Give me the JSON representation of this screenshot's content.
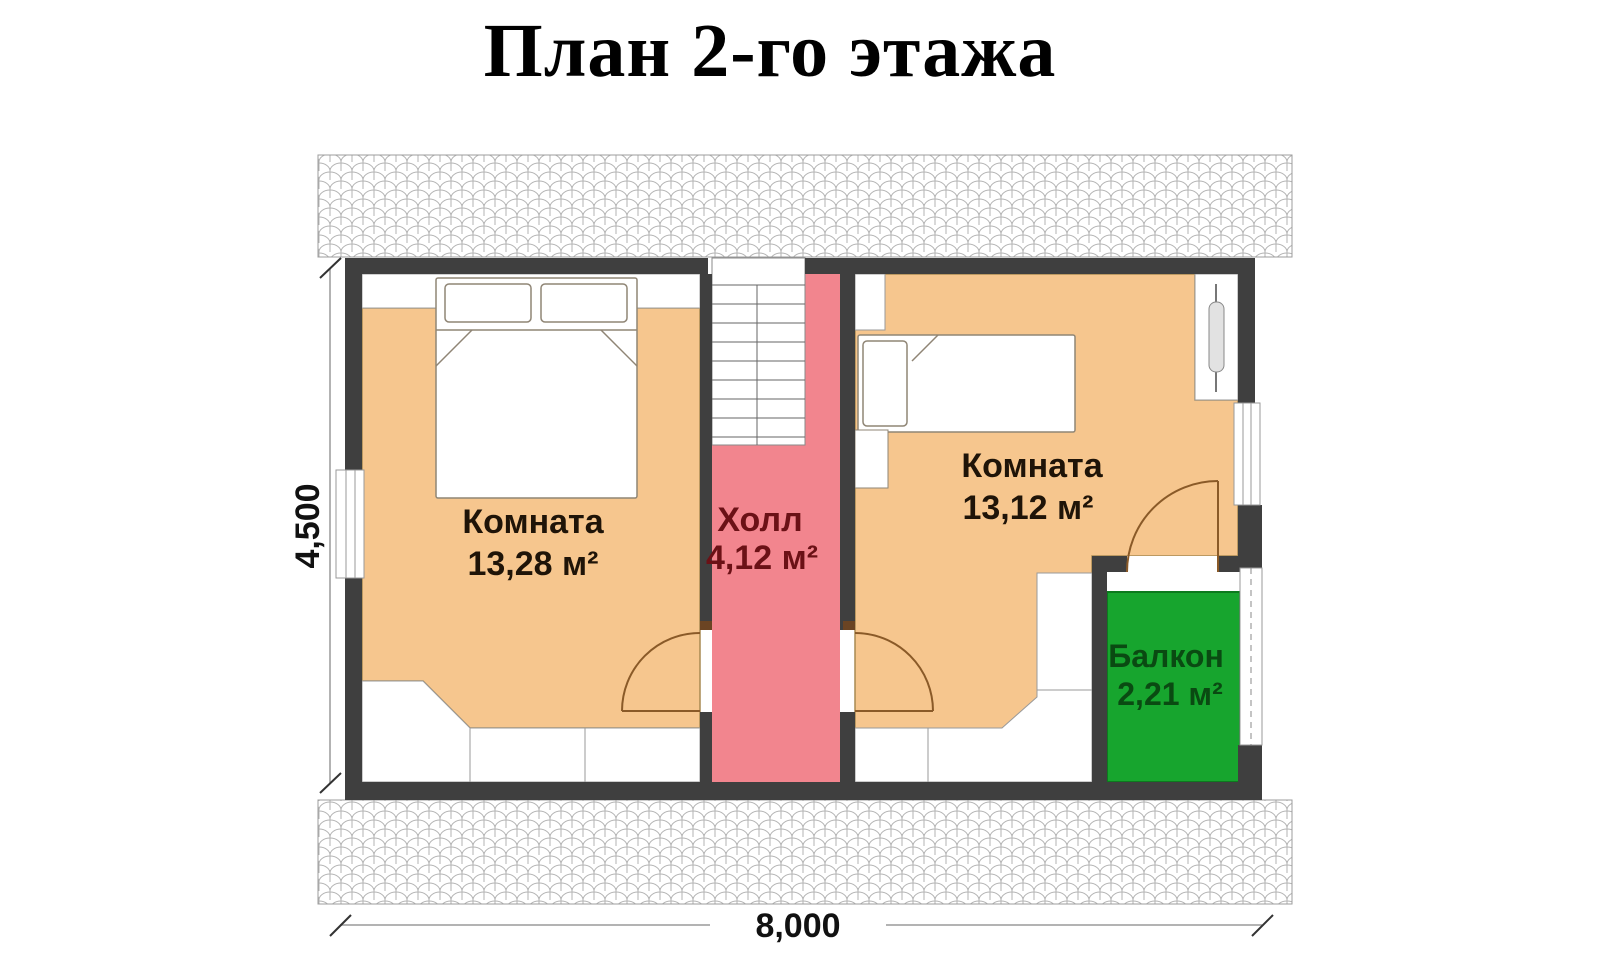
{
  "title": "План 2-го этажа",
  "rooms": {
    "bedroom_left": {
      "label": "Комната",
      "area": "13,28 м²"
    },
    "hall": {
      "label": "Холл",
      "area": "4,12 м²"
    },
    "bedroom_right": {
      "label": "Комната",
      "area": "13,12 м²"
    },
    "balcony": {
      "label": "Балкон",
      "area": "2,21 м²"
    }
  },
  "dimensions": {
    "horizontal": "8,000",
    "vertical": "4,500"
  },
  "colors": {
    "wall": "#3f3f3f",
    "room_fill": "#f6c68e",
    "hall_fill": "#f2858e",
    "balcony_fill": "#17a52e",
    "room_label_color": "#1f1408",
    "hall_label_color": "#6b1116",
    "balcony_label_color": "#0a4a12"
  }
}
